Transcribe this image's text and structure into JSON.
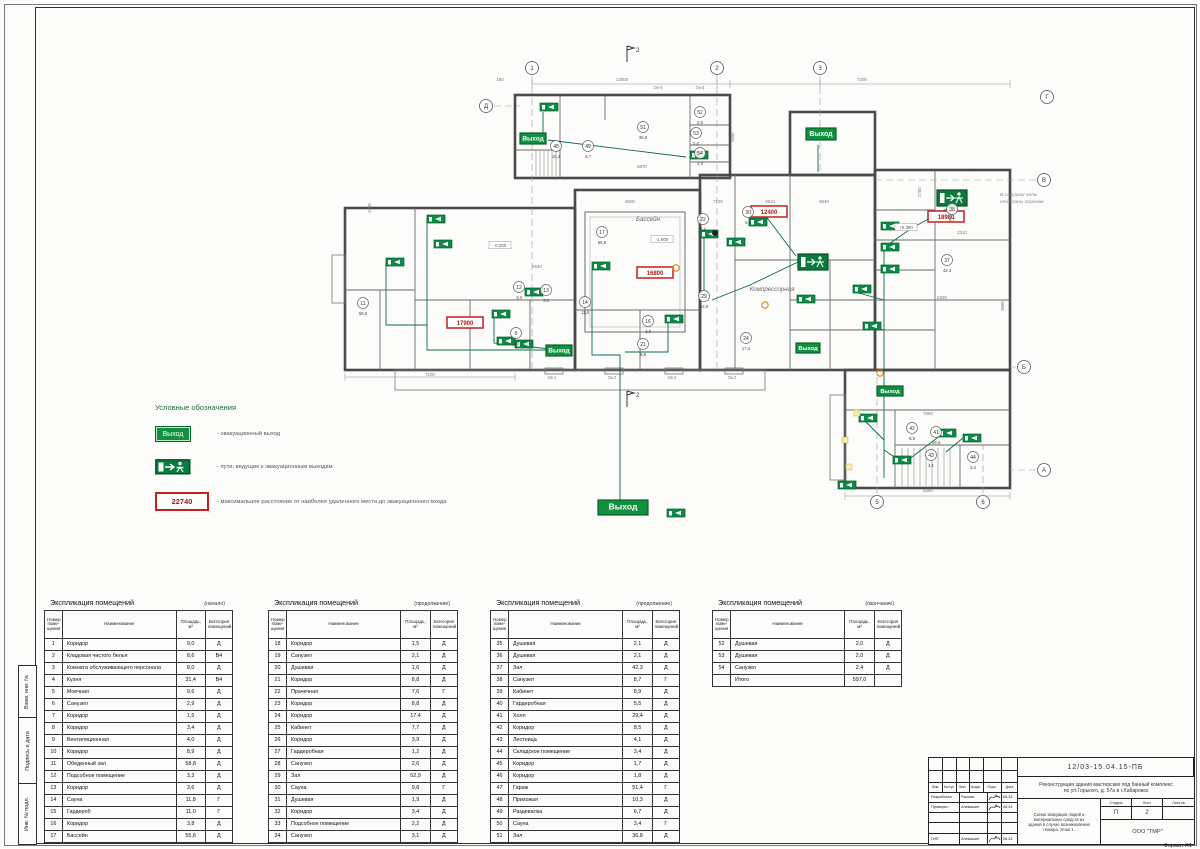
{
  "sheet": {
    "format_label": "Формат А1",
    "side_labels": [
      "Взам. инв. №",
      "Подпись и дата",
      "Инв. № подл."
    ]
  },
  "legend": {
    "title": "Условные обозначения",
    "exit_sign_text": "Выход",
    "distance_value": "22740",
    "items": [
      {
        "label": "-  эвакуационный выход"
      },
      {
        "label": "-  пути, ведущие к эвакуационным выходам"
      },
      {
        "label": "-  максимальное расстояние от наиболее удаленного места до эвакуационного входа"
      }
    ]
  },
  "plan": {
    "exit_label": "Выход",
    "note_line1": "В санузлах полы",
    "note_line2": "отделаны порогом",
    "room_labels": [
      {
        "t": "Бассейн",
        "x": 648,
        "y": 221
      },
      {
        "t": "Компрессорная",
        "x": 772,
        "y": 291
      }
    ],
    "elevations": [
      {
        "t": "-1.600",
        "x": 662,
        "y": 241
      },
      {
        "t": "-0.200",
        "x": 500,
        "y": 247
      },
      {
        "t": "+0.350",
        "x": 906,
        "y": 229
      }
    ],
    "exits": [
      {
        "x": 520,
        "y": 133,
        "w": 26,
        "h": 11
      },
      {
        "x": 806,
        "y": 128,
        "w": 30,
        "h": 12
      },
      {
        "x": 546,
        "y": 345,
        "w": 26,
        "h": 11
      },
      {
        "x": 796,
        "y": 343,
        "w": 24,
        "h": 10
      },
      {
        "x": 598,
        "y": 500,
        "w": 50,
        "h": 15
      },
      {
        "x": 877,
        "y": 386,
        "w": 26,
        "h": 10
      }
    ],
    "runner_signs": [
      {
        "x": 798,
        "y": 254,
        "w": 30,
        "h": 16
      },
      {
        "x": 937,
        "y": 190,
        "w": 30,
        "h": 16
      }
    ],
    "route_markers": [
      {
        "x": 540,
        "y": 103
      },
      {
        "x": 690,
        "y": 151
      },
      {
        "x": 427,
        "y": 215
      },
      {
        "x": 434,
        "y": 240
      },
      {
        "x": 386,
        "y": 258
      },
      {
        "x": 492,
        "y": 310
      },
      {
        "x": 497,
        "y": 337
      },
      {
        "x": 515,
        "y": 340
      },
      {
        "x": 525,
        "y": 288
      },
      {
        "x": 592,
        "y": 262
      },
      {
        "x": 665,
        "y": 315
      },
      {
        "x": 700,
        "y": 230
      },
      {
        "x": 727,
        "y": 238
      },
      {
        "x": 749,
        "y": 218
      },
      {
        "x": 797,
        "y": 295
      },
      {
        "x": 881,
        "y": 222
      },
      {
        "x": 881,
        "y": 243
      },
      {
        "x": 881,
        "y": 265
      },
      {
        "x": 853,
        "y": 285
      },
      {
        "x": 863,
        "y": 322
      },
      {
        "x": 859,
        "y": 414
      },
      {
        "x": 893,
        "y": 456
      },
      {
        "x": 938,
        "y": 429
      },
      {
        "x": 963,
        "y": 434
      },
      {
        "x": 667,
        "y": 509
      },
      {
        "x": 838,
        "y": 481
      }
    ],
    "distance_boxes": [
      {
        "v": "17900",
        "x": 447,
        "y": 317
      },
      {
        "v": "16800",
        "x": 637,
        "y": 267
      },
      {
        "v": "12400",
        "x": 751,
        "y": 206
      },
      {
        "v": "18980",
        "x": 928,
        "y": 211
      }
    ],
    "room_circles": [
      {
        "n": "48",
        "a": "10,3",
        "x": 556,
        "y": 146
      },
      {
        "n": "49",
        "a": "6,7",
        "x": 588,
        "y": 146
      },
      {
        "n": "51",
        "a": "36,8",
        "x": 643,
        "y": 127
      },
      {
        "n": "52",
        "a": "2,0",
        "x": 700,
        "y": 112
      },
      {
        "n": "53",
        "a": "2,0",
        "x": 696,
        "y": 133
      },
      {
        "n": "54",
        "a": "2,4",
        "x": 700,
        "y": 153
      },
      {
        "n": "12",
        "a": "3,3",
        "x": 519,
        "y": 287
      },
      {
        "n": "13",
        "a": "3,6",
        "x": 546,
        "y": 290
      },
      {
        "n": "14",
        "a": "11,8",
        "x": 585,
        "y": 302
      },
      {
        "n": "9",
        "a": "4,0",
        "x": 516,
        "y": 333
      },
      {
        "n": "11",
        "a": "58,8",
        "x": 363,
        "y": 303
      },
      {
        "n": "16",
        "a": "3,8",
        "x": 648,
        "y": 321
      },
      {
        "n": "21",
        "a": "8,8",
        "x": 643,
        "y": 344
      },
      {
        "n": "22",
        "a": "7,6",
        "x": 703,
        "y": 219
      },
      {
        "n": "24",
        "a": "17,4",
        "x": 746,
        "y": 338
      },
      {
        "n": "29",
        "a": "52,9",
        "x": 704,
        "y": 296
      },
      {
        "n": "30",
        "a": "9,8",
        "x": 748,
        "y": 212
      },
      {
        "n": "37",
        "a": "42,3",
        "x": 947,
        "y": 260
      },
      {
        "n": "38",
        "a": "8,7",
        "x": 952,
        "y": 209
      },
      {
        "n": "41",
        "a": "29,4",
        "x": 936,
        "y": 432
      },
      {
        "n": "42",
        "a": "8,5",
        "x": 912,
        "y": 428
      },
      {
        "n": "43",
        "a": "4,1",
        "x": 931,
        "y": 455
      },
      {
        "n": "44",
        "a": "3,4",
        "x": 973,
        "y": 457
      },
      {
        "n": "17",
        "a": "55,6",
        "x": 602,
        "y": 232
      }
    ],
    "dimensions": [
      {
        "t": "13000",
        "x": 622,
        "y": 81
      },
      {
        "t": "7200",
        "x": 862,
        "y": 81
      },
      {
        "t": "190",
        "x": 500,
        "y": 81
      },
      {
        "t": "8600",
        "x": 630,
        "y": 203
      },
      {
        "t": "7720",
        "x": 718,
        "y": 203
      },
      {
        "t": "3810",
        "x": 770,
        "y": 203
      },
      {
        "t": "5640",
        "x": 824,
        "y": 203
      },
      {
        "t": "4540",
        "x": 537,
        "y": 268
      },
      {
        "t": "5870",
        "x": 642,
        "y": 168
      },
      {
        "t": "2310",
        "x": 962,
        "y": 234
      },
      {
        "t": "7050",
        "x": 928,
        "y": 415
      },
      {
        "t": "5320",
        "x": 942,
        "y": 299
      },
      {
        "t": "7100",
        "x": 430,
        "y": 376
      },
      {
        "t": "8280",
        "x": 928,
        "y": 492
      },
      {
        "t": "5850",
        "x": 734,
        "y": 137,
        "r": -90
      },
      {
        "t": "2400",
        "x": 371,
        "y": 208,
        "r": -90
      },
      {
        "t": "2750",
        "x": 921,
        "y": 192,
        "r": -90
      },
      {
        "t": "9580",
        "x": 1004,
        "y": 306,
        "r": -90
      }
    ],
    "window_labels": [
      {
        "t": "Ок-1",
        "x": 552,
        "y": 379
      },
      {
        "t": "Ок-2",
        "x": 612,
        "y": 379
      },
      {
        "t": "Ок-2",
        "x": 672,
        "y": 379
      },
      {
        "t": "Ок-2",
        "x": 732,
        "y": 379
      },
      {
        "t": "Ок-4",
        "x": 658,
        "y": 89
      },
      {
        "t": "Ок-4",
        "x": 700,
        "y": 89
      }
    ],
    "grid_bubbles": [
      {
        "l": "1",
        "x": 532,
        "y": 68
      },
      {
        "l": "2",
        "x": 717,
        "y": 68
      },
      {
        "l": "3",
        "x": 820,
        "y": 68
      },
      {
        "l": "Г",
        "x": 1047,
        "y": 97
      },
      {
        "l": "В",
        "x": 1044,
        "y": 180
      },
      {
        "l": "Б",
        "x": 1024,
        "y": 367
      },
      {
        "l": "А",
        "x": 1044,
        "y": 470
      },
      {
        "l": "Д",
        "x": 486,
        "y": 106
      },
      {
        "l": "5",
        "x": 877,
        "y": 502
      },
      {
        "l": "6",
        "x": 983,
        "y": 502
      }
    ],
    "section_marks": [
      {
        "l": "2",
        "x": 627,
        "y": 54
      },
      {
        "l": "2",
        "x": 627,
        "y": 399
      }
    ]
  },
  "tables": [
    {
      "title": "Экспликация помещений",
      "subtitle": "(начало)",
      "headers": [
        "Номер поме- щения",
        "Наименование",
        "Площадь, м²",
        "Категория помещений"
      ],
      "rows": [
        [
          "1",
          "Коридор",
          "9,0",
          "Д"
        ],
        [
          "2",
          "Кладовая чистого белья",
          "8,6",
          "В4"
        ],
        [
          "3",
          "Комната обслуживающего персонала",
          "8,0",
          "Д"
        ],
        [
          "4",
          "Кухня",
          "31,4",
          "В4"
        ],
        [
          "5",
          "Моечная",
          "9,6",
          "Д"
        ],
        [
          "6",
          "Санузел",
          "2,9",
          "Д"
        ],
        [
          "7",
          "Коридор",
          "1,5",
          "Д"
        ],
        [
          "8",
          "Коридор",
          "3,4",
          "Д"
        ],
        [
          "9",
          "Вентиляционная",
          "4,0",
          "Д"
        ],
        [
          "10",
          "Коридор",
          "8,9",
          "Д"
        ],
        [
          "11",
          "Обеденный зал",
          "58,8",
          "Д"
        ],
        [
          "12",
          "Подсобное помещение",
          "3,3",
          "Д"
        ],
        [
          "13",
          "Коридор",
          "3,6",
          "Д"
        ],
        [
          "14",
          "Сауна",
          "11,8",
          "Г"
        ],
        [
          "15",
          "Гардероб",
          "11,0",
          "Г"
        ],
        [
          "16",
          "Коридор",
          "3,8",
          "Д"
        ],
        [
          "17",
          "Бассейн",
          "55,6",
          "Д"
        ]
      ]
    },
    {
      "title": "Экспликация помещений",
      "subtitle": "(продолжение)",
      "headers": [
        "Номер поме- щения",
        "Наименование",
        "Площадь, м²",
        "Категория помещений"
      ],
      "rows": [
        [
          "18",
          "Коридор",
          "1,5",
          "Д"
        ],
        [
          "19",
          "Санузел",
          "2,1",
          "Д"
        ],
        [
          "20",
          "Душевая",
          "1,6",
          "Д"
        ],
        [
          "21",
          "Коридор",
          "8,8",
          "Д"
        ],
        [
          "22",
          "Прачечная",
          "7,6",
          "Г"
        ],
        [
          "23",
          "Коридор",
          "8,8",
          "Д"
        ],
        [
          "24",
          "Коридор",
          "17,4",
          "Д"
        ],
        [
          "25",
          "Кабинет",
          "7,7",
          "Д"
        ],
        [
          "26",
          "Коридор",
          "3,9",
          "Д"
        ],
        [
          "27",
          "Гардеробная",
          "1,2",
          "Д"
        ],
        [
          "28",
          "Санузел",
          "2,6",
          "Д"
        ],
        [
          "29",
          "Зал",
          "52,9",
          "Д"
        ],
        [
          "30",
          "Сауна",
          "9,8",
          "Г"
        ],
        [
          "31",
          "Душевая",
          "1,9",
          "Д"
        ],
        [
          "32",
          "Коридор",
          "3,4",
          "Д"
        ],
        [
          "33",
          "Подсобное помещение",
          "2,2",
          "Д"
        ],
        [
          "34",
          "Санузел",
          "3,1",
          "Д"
        ]
      ]
    },
    {
      "title": "Экспликация помещений",
      "subtitle": "(продолжение)",
      "headers": [
        "Номер поме- щения",
        "Наименование",
        "Площадь, м²",
        "Категория помещений"
      ],
      "rows": [
        [
          "35",
          "Душевая",
          "2,1",
          "Д"
        ],
        [
          "36",
          "Душевая",
          "2,1",
          "Д"
        ],
        [
          "37",
          "Зал",
          "42,3",
          "Д"
        ],
        [
          "38",
          "Санузел",
          "8,7",
          "Г"
        ],
        [
          "39",
          "Кабинет",
          "8,9",
          "Д"
        ],
        [
          "40",
          "Гардеробная",
          "5,5",
          "Д"
        ],
        [
          "41",
          "Холл",
          "29,4",
          "Д"
        ],
        [
          "42",
          "Коридор",
          "8,5",
          "Д"
        ],
        [
          "43",
          "Лестница",
          "4,1",
          "Д"
        ],
        [
          "44",
          "Складское помещение",
          "3,4",
          "Д"
        ],
        [
          "45",
          "Коридор",
          "1,7",
          "Д"
        ],
        [
          "46",
          "Коридор",
          "1,8",
          "Д"
        ],
        [
          "47",
          "Гараж",
          "51,4",
          "Г"
        ],
        [
          "48",
          "Прихожая",
          "10,3",
          "Д"
        ],
        [
          "49",
          "Раздевалка",
          "6,7",
          "Д"
        ],
        [
          "50",
          "Сауна",
          "3,4",
          "Г"
        ],
        [
          "51",
          "Зал",
          "36,8",
          "Д"
        ]
      ]
    },
    {
      "title": "Экспликация помещений",
      "subtitle": "(окончание)",
      "headers": [
        "Номер поме- щения",
        "Наименование",
        "Площадь, м²",
        "Категория помещений"
      ],
      "rows": [
        [
          "52",
          "Душевая",
          "2,0",
          "Д"
        ],
        [
          "53",
          "Душевая",
          "2,0",
          "Д"
        ],
        [
          "54",
          "Санузел",
          "2,4",
          "Д"
        ],
        [
          "",
          "Итого",
          "597,0",
          ""
        ]
      ]
    }
  ],
  "title_block": {
    "doc_number": "12/03-15.04.15-ПБ",
    "project_line1": "Реконструкция здания мастерских под банный комплекс",
    "project_line2": "по ул.Горького, д. 57а в г.Хабаровск",
    "sheet_title_1": "Схема эвакуации людей и материальных средств из",
    "sheet_title_2": "здания в случае возникновения пожара. Этаж 1.",
    "org": "ООО \"ТМР\"",
    "stage_label": "Стадия",
    "sheet_label": "Лист",
    "sheets_label": "Листов",
    "stage": "П",
    "sheet_num": "2",
    "header_cols": [
      "Изм.",
      "Кол.уч",
      "Лист",
      "№док.",
      "Подп.",
      "Дата"
    ],
    "sign_rows": [
      {
        "role": "Разработал",
        "name": "Рыкова",
        "date": "06.24"
      },
      {
        "role": "Проверил",
        "name": "Алемыкин",
        "date": "06.24"
      },
      {
        "role": "",
        "name": "",
        "date": ""
      },
      {
        "role": "",
        "name": "",
        "date": ""
      },
      {
        "role": "ГИП",
        "name": "Алемыкин",
        "date": "06.24"
      }
    ]
  }
}
